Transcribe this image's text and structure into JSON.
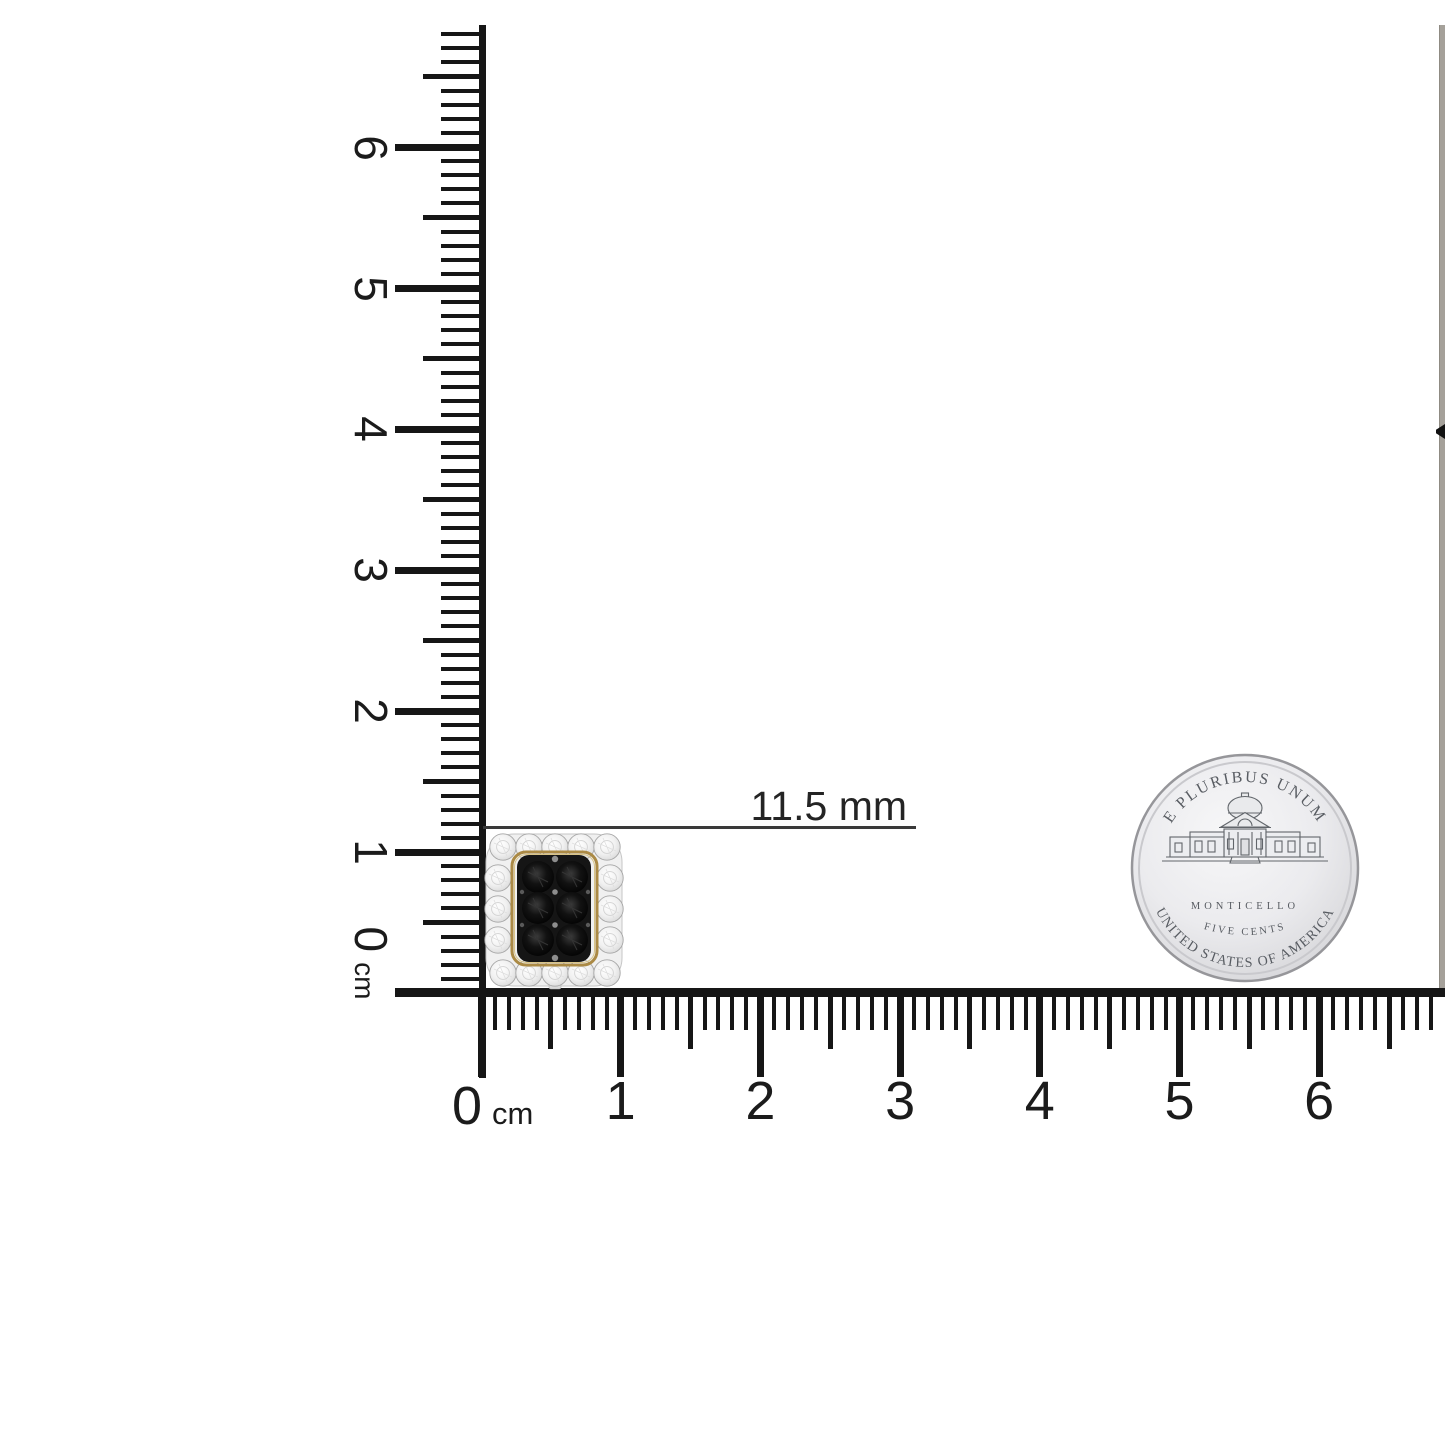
{
  "measurement": {
    "label": "11.5 mm"
  },
  "vertical_ruler": {
    "zero": "0",
    "unit": "cm",
    "numbers": [
      "1",
      "2",
      "3",
      "4",
      "5",
      "6"
    ]
  },
  "horizontal_ruler": {
    "zero": "0",
    "unit": "cm",
    "numbers": [
      "1",
      "2",
      "3",
      "4",
      "5",
      "6"
    ]
  },
  "coin": {
    "top_text": "E PLURIBUS UNUM",
    "building_label": "MONTICELLO",
    "denomination": "FIVE CENTS",
    "bottom_text": "UNITED STATES OF AMERICA"
  },
  "earring": {
    "description": "black diamond cluster stud earring with round white diamond halo",
    "stone_color": "#0c0c0c",
    "halo_color": "#f5f5f5",
    "gold_accent": "#ab8a45"
  },
  "colors": {
    "background": "#ffffff",
    "ruler_ink": "#161616",
    "measure_ink": "#3a3a3a",
    "coin_ink": "#585c62"
  }
}
